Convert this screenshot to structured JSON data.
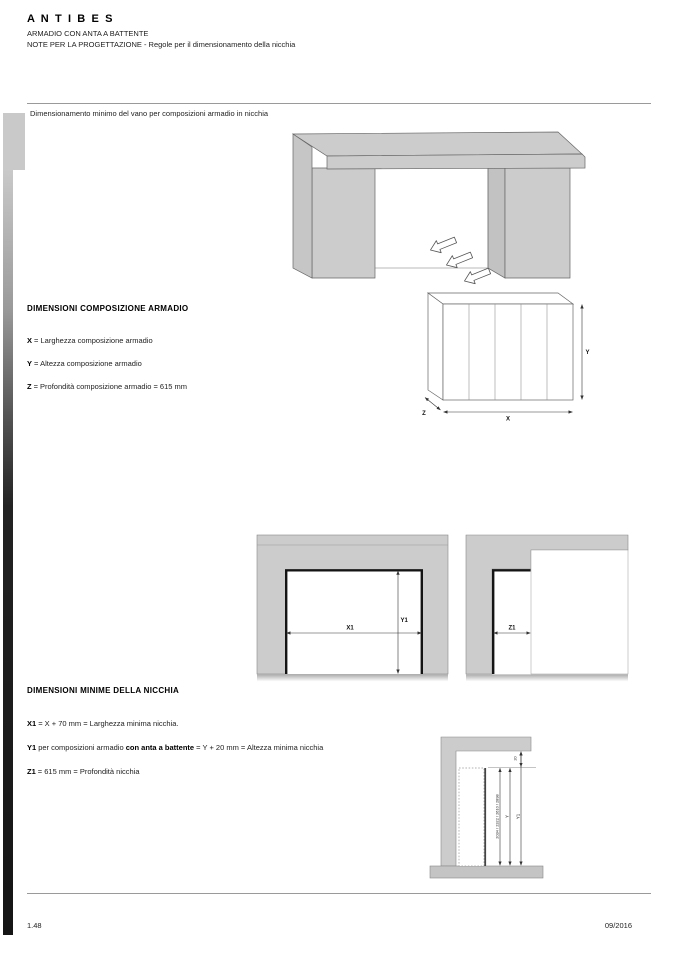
{
  "header": {
    "brand": "A N T I B E S",
    "line1": "ARMADIO CON ANTA A BATTENTE",
    "line2": "NOTE PER LA PROGETTAZIONE - Regole per il dimensionamento della nicchia"
  },
  "intro_caption": "Dimensionamento minimo del vano per composizioni armadio in nicchia",
  "section_composizione": {
    "title": "DIMENSIONI COMPOSIZIONE ARMADIO",
    "items": [
      {
        "key": "X",
        "text": "= Larghezza composizione armadio"
      },
      {
        "key": "Y",
        "text": "= Altezza composizione armadio"
      },
      {
        "key": "Z",
        "text": "= Profondità composizione armadio = 615 mm"
      }
    ]
  },
  "section_nicchia": {
    "title": "DIMENSIONI MINIME DELLA NICCHIA",
    "items": [
      {
        "key": "X1",
        "pre": "",
        "bold": "",
        "post": "= X + 70 mm = Larghezza minima nicchia."
      },
      {
        "key": "Y1",
        "pre": "per composizioni armadio ",
        "bold": "con anta a battente",
        "post": " = Y + 20 mm = Altezza minima nicchia"
      },
      {
        "key": "Z1",
        "pre": "",
        "bold": "",
        "post": "= 615 mm = Profondità nicchia"
      }
    ]
  },
  "diagram_labels": {
    "x": "X",
    "y": "Y",
    "z": "Z",
    "x1": "X1",
    "y1": "Y1",
    "z1": "Z1",
    "gap": "20",
    "heights": "2034 / 2322 / 2610 / 2898",
    "side_y": "Y",
    "side_y1": "Y1"
  },
  "footer": {
    "page": "1.48",
    "date": "09/2016"
  },
  "colors": {
    "diagram_gray": "#cccccc",
    "outline": "#777777",
    "accent_black": "#141414"
  }
}
